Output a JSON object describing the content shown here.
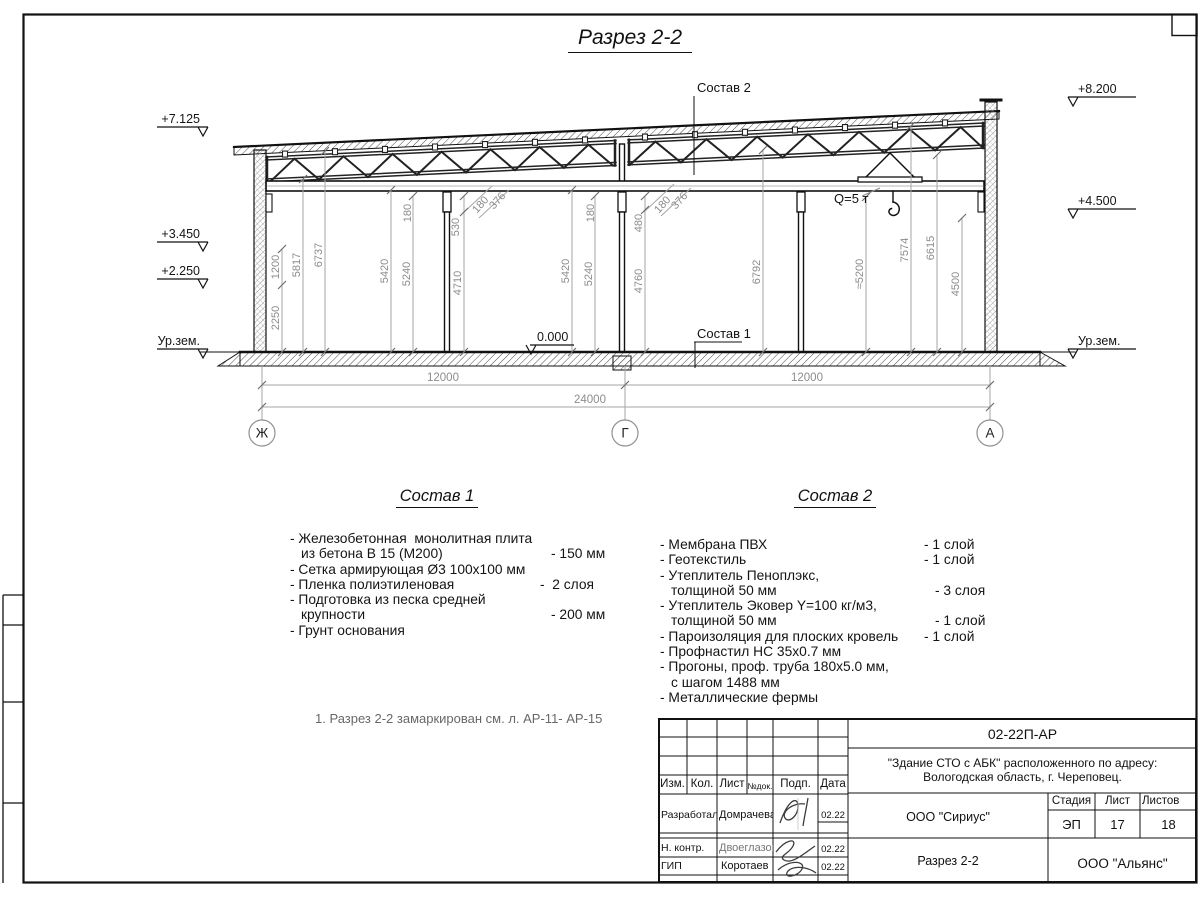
{
  "sheet": {
    "title": "Разрез 2-2",
    "note": "1. Разрез 2-2 замаркирован см. л. АР-11- АР-15"
  },
  "elevations": {
    "left": [
      "+7.125",
      "+3.450",
      "+2.250",
      "Ур.зем."
    ],
    "right": [
      "+8.200",
      "+4.500",
      "Ур.зем."
    ],
    "zero": "0.000"
  },
  "callouts": {
    "sostav2": "Состав 2",
    "sostav1": "Состав 1",
    "crane_capacity": "Q=5 т"
  },
  "axes": [
    "Ж",
    "Г",
    "А"
  ],
  "dims": {
    "vertical": [
      "2250",
      "1200",
      "5817",
      "6737",
      "5420",
      "5240",
      "180",
      "530",
      "4710",
      "180",
      "376",
      "5420",
      "5240",
      "180",
      "480",
      "4760",
      "180",
      "376",
      "6792",
      "≈5200",
      "7574",
      "6615",
      "4500"
    ],
    "horizontal": [
      "12000",
      "12000",
      "24000"
    ]
  },
  "sostav1": {
    "title": "Состав 1",
    "rows": [
      {
        "t": "- Железобетонная  монолитная плита",
        "v": ""
      },
      {
        "t": "из бетона В 15 (М200)",
        "v": "- 150 мм"
      },
      {
        "t": "- Сетка армирующая Ø3 100х100 мм",
        "v": ""
      },
      {
        "t": "- Пленка полиэтиленовая",
        "v": "-  2 слоя"
      },
      {
        "t": "- Подготовка из песка средней",
        "v": ""
      },
      {
        "t": "крупности",
        "v": "- 200 мм"
      },
      {
        "t": "- Грунт основания",
        "v": ""
      }
    ]
  },
  "sostav2": {
    "title": "Состав 2",
    "rows": [
      {
        "t": "- Мембрана ПВХ",
        "v": "- 1 слой"
      },
      {
        "t": "- Геотекстиль",
        "v": "- 1 слой"
      },
      {
        "t": "- Утеплитель Пеноплэкс,",
        "v": ""
      },
      {
        "t": "толщиной 50 мм",
        "v": "- 3 слоя"
      },
      {
        "t": "- Утеплитель Эковер Y=100 кг/м3,",
        "v": ""
      },
      {
        "t": "толщиной 50 мм",
        "v": "- 1 слой"
      },
      {
        "t": "- Пароизоляция для плоских кровель",
        "v": "- 1 слой"
      },
      {
        "t": "- Профнастил НС 35х0.7 мм",
        "v": ""
      },
      {
        "t": "- Прогоны, проф. труба 180х5.0 мм,",
        "v": ""
      },
      {
        "t": "с шагом 1488 мм",
        "v": ""
      },
      {
        "t": "- Металлические фермы",
        "v": ""
      }
    ]
  },
  "titleblock": {
    "code": "02-22П-АР",
    "project_line1": "\"Здание СТО с АБК\" расположенного по адресу:",
    "project_line2": "Вологодская область, г. Череповец.",
    "header": [
      "Изм.",
      "Кол.",
      "Лист",
      "№док.",
      "Подп.",
      "Дата"
    ],
    "rows": [
      {
        "role": "Разработал",
        "name": "Домрачева",
        "date": "02.22"
      },
      {
        "role": "Н. контр.",
        "name": "Двоеглазов",
        "date": "02.22"
      },
      {
        "role": "ГИП",
        "name": "Коротаев",
        "date": "02.22"
      }
    ],
    "org1": "ООО \"Сириус\"",
    "sheet_title": "Разрез 2-2",
    "stage_label": "Стадия",
    "sheet_label": "Лист",
    "sheets_label": "Листов",
    "stage": "ЭП",
    "sheet_no": "17",
    "sheets_total": "18",
    "org2": "ООО \"Альянс\""
  }
}
